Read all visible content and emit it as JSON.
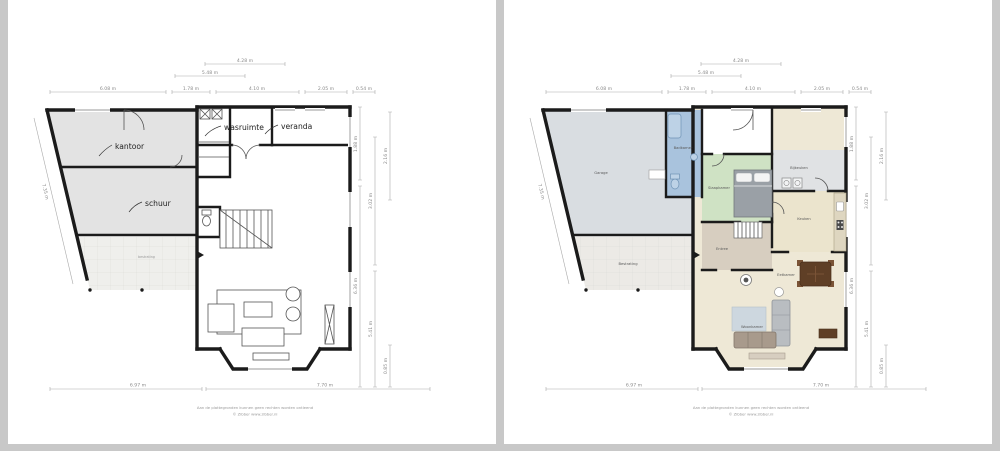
{
  "title": "Impressie",
  "footer": {
    "disclaimer": "Aan de plattegronden kunnen geen rechten worden ontleend",
    "credit": "© Zibber www.zibber.nl"
  },
  "dims": {
    "top_width": "4.28 m",
    "top_inner": "5.48 m",
    "top_row": [
      "6.08 m",
      "1.78 m",
      "4.10 m",
      "2.05 m",
      "0.54 m"
    ],
    "right_inner": [
      "1.88 m",
      "6.36 m"
    ],
    "right_mid": [
      "3.02 m",
      "5.41 m"
    ],
    "right_outer": [
      "2.16 m",
      "0.85 m"
    ],
    "bottom_left": "6.97 m",
    "bottom_right": "7.70 m",
    "left_diagonal": "7.35 m"
  },
  "outline_plan": {
    "labels": {
      "kantoor": "kantoor",
      "wasruimte": "wasruimte",
      "veranda": "veranda",
      "schuur": "schuur",
      "bestrating": "bestrating"
    }
  },
  "color_plan": {
    "labels": {
      "garage": "Garage",
      "badkamer": "Badkamer",
      "slaapkamer": "Slaapkamer",
      "bijkeuken": "Bijkeuken",
      "keuken": "Keuken",
      "entree": "Entree",
      "eetkamer": "Eetkamer",
      "woonkamer": "Woonkamer",
      "bestrating": "Bestrating"
    }
  },
  "colors": {
    "wall": "#1b1b1b",
    "room_gray": "#e3e3e3",
    "terrace": "#efefec",
    "garage": "#d9dde1",
    "badkamer": "#a9c3dd",
    "fixture_blue": "#bdd2e6",
    "slaapkamer": "#cfe2c4",
    "bijkeuken": "#e0e2e4",
    "keuken": "#ebe4cd",
    "counter": "#ded6c0",
    "entree": "#d7cec0",
    "living": "#eee8d6",
    "table_brown": "#5f3f26",
    "sofa": "#b9bdc1",
    "sofa2": "#a89a8c",
    "rug": "#cdd7df",
    "bed": "#9aa0a6"
  }
}
